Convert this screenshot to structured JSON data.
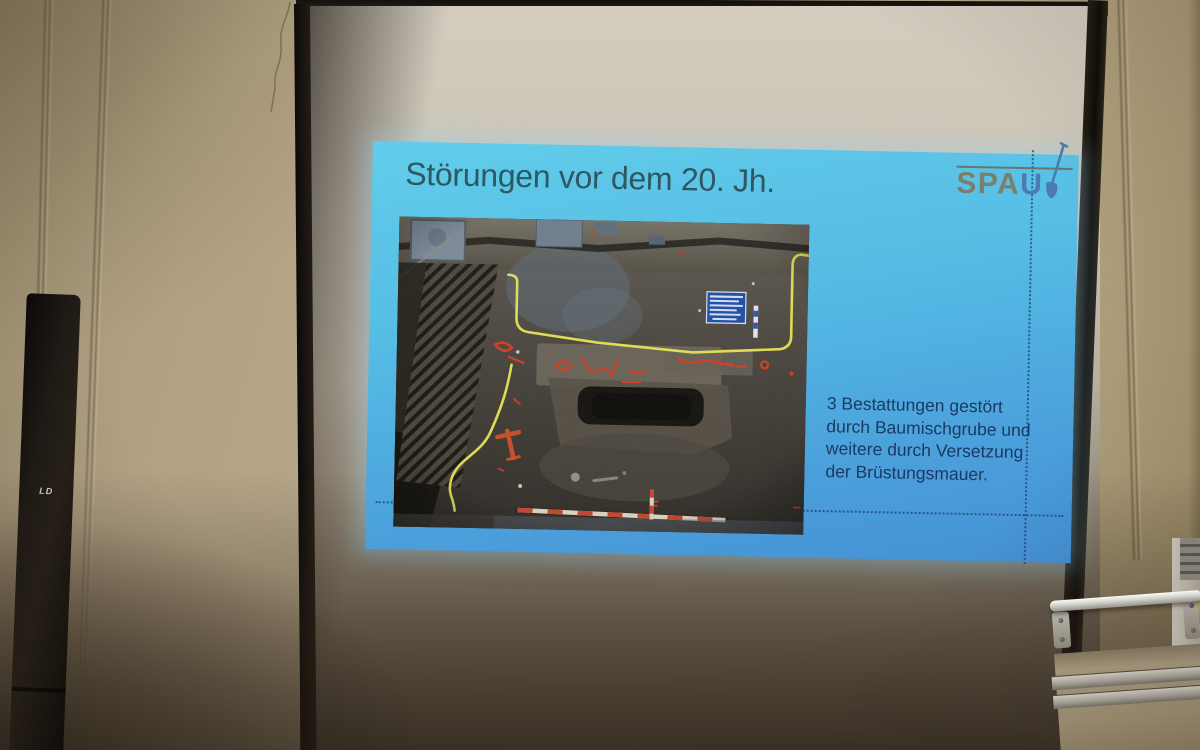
{
  "slide": {
    "title": "Störungen vor dem 20. Jh.",
    "logo": {
      "text_gray": "SPA",
      "text_blue": "U",
      "icon": "shovel-icon"
    },
    "body_lines": [
      "3 Bestattungen gestört",
      "durch Baumischgrube und",
      "weitere durch Versetzung",
      "der Brüstungsmauer."
    ],
    "colors": {
      "background_top": "#62cdea",
      "background_bottom": "#4590d5",
      "title_text": "#2e5864",
      "body_text": "#1b3a63",
      "dotted_guides": "#1d4070",
      "logo_gray": "#7d7f6d",
      "logo_blue": "#4a7cb0"
    }
  },
  "photo_annotations": {
    "yellow_outline": "#e8e553",
    "red_chalk_marks": "#cf3d20",
    "record_board_blue": "#1e4da6",
    "scale_rod_red": "#c6432a"
  },
  "room": {
    "speaker_label": "LD"
  }
}
